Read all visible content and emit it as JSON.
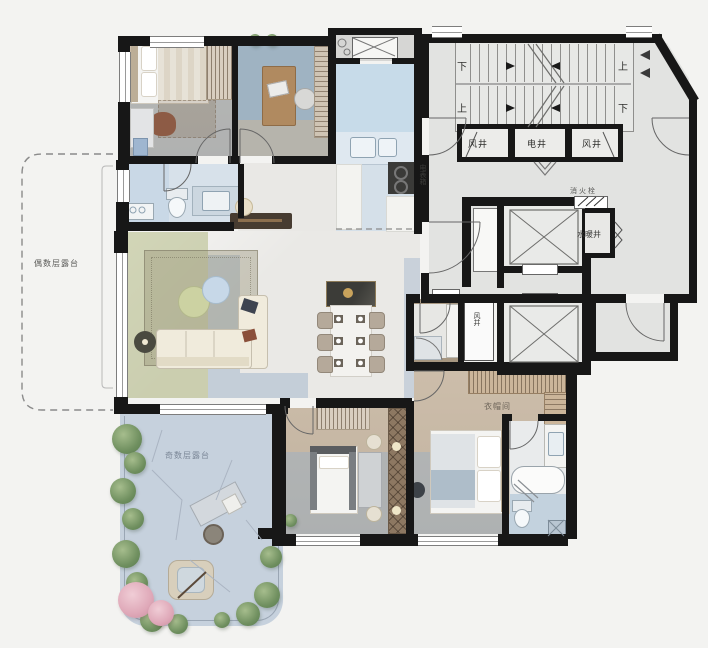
{
  "palette": {
    "background": "#f3f3f1",
    "wall": "#171717",
    "core_floor": "#e2e3e1",
    "marble": "#eae9e6",
    "wood": "#c8b9a6",
    "blue_wash": "#a9c0d4",
    "green_wash": "#aab470",
    "terrace_stone": "#c6d1dd",
    "tree_green": "#6f8f5f",
    "tree_pink": "#dfa8b8"
  },
  "labels": {
    "even_terrace": "偶数层露台",
    "odd_terrace": "奇数层露台",
    "shaft_cells": [
      "风井",
      "电井",
      "风井"
    ],
    "hydrant": "消火栓",
    "water_shaft": "水暖井",
    "meter_box": "电表箱",
    "closet": "衣帽间",
    "bath_shaft": "风井",
    "stairs": {
      "upper_left": "下",
      "upper_right": "上",
      "lower_left": "上",
      "lower_right": "下"
    }
  }
}
